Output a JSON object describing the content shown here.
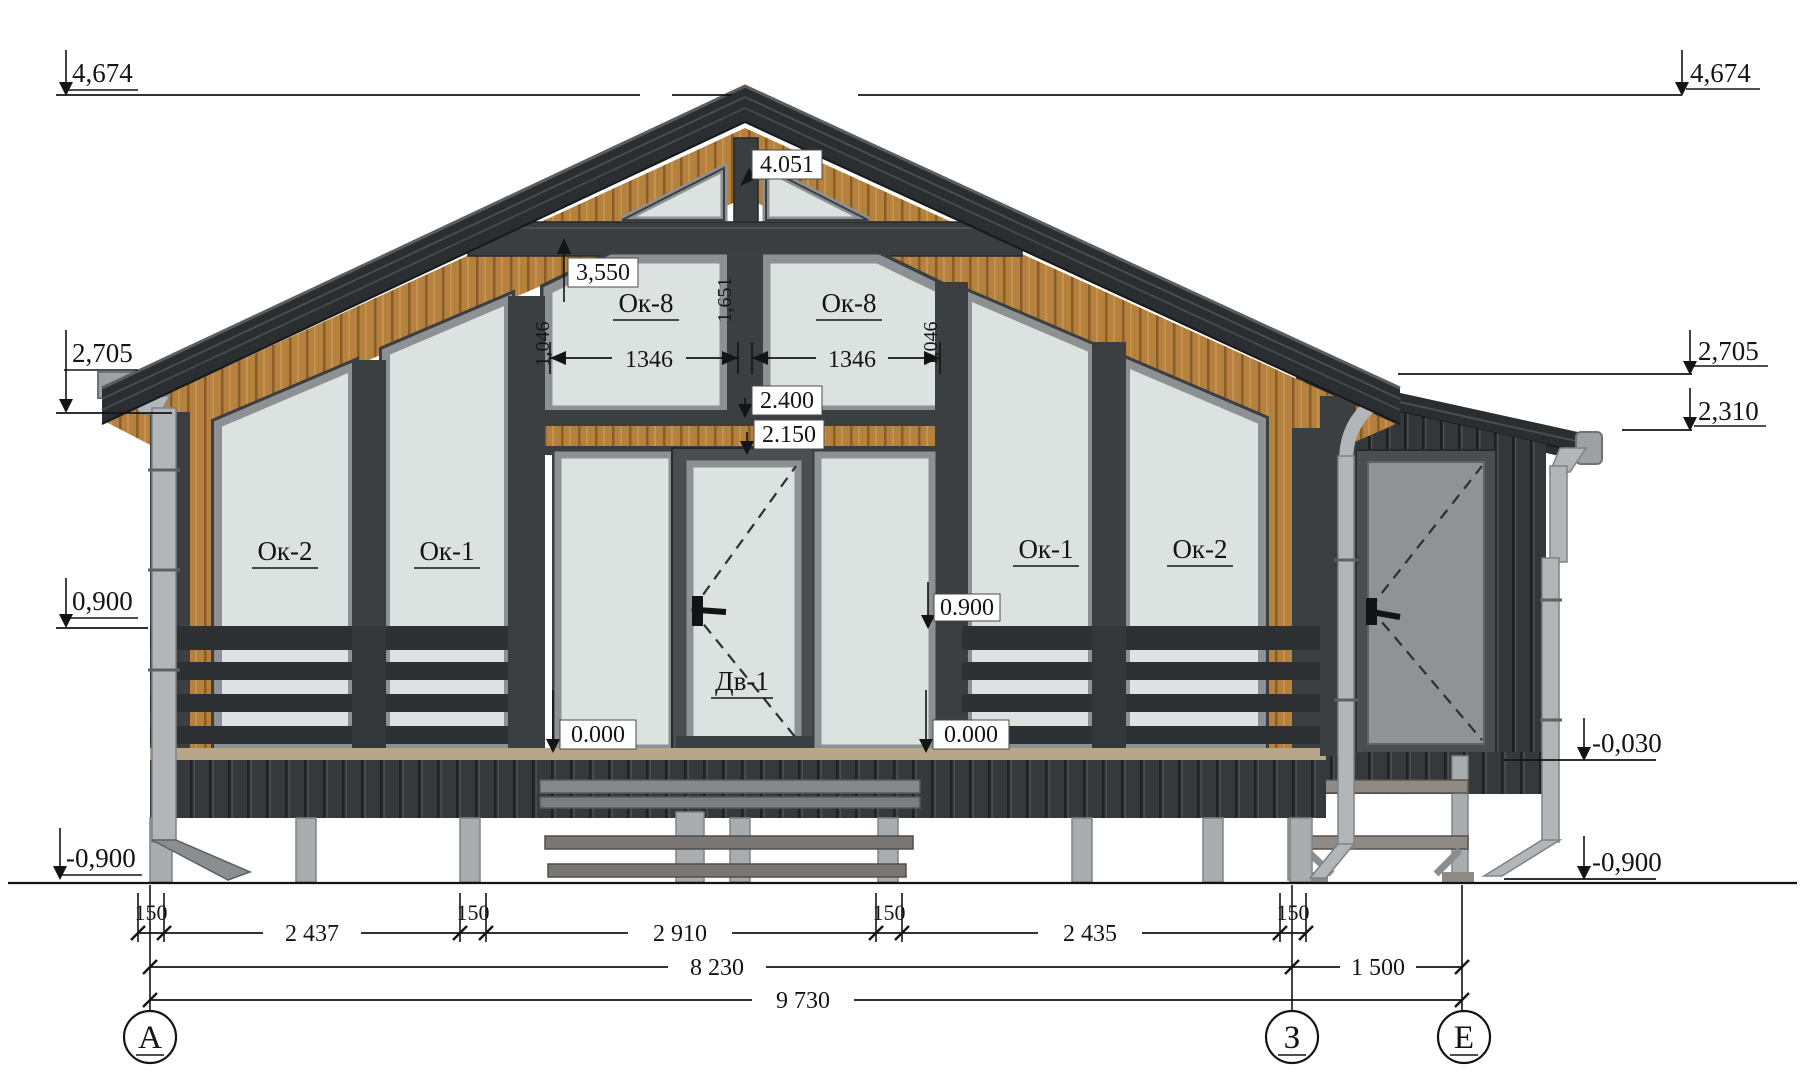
{
  "drawing": {
    "type": "architectural-elevation",
    "levels_left": {
      "l0": "4,674",
      "l1": "2,705",
      "l2": "0,900",
      "l3": "-0,900"
    },
    "levels_right": {
      "r0": "4,674",
      "r1": "2,705",
      "r2": "2,310",
      "r3": "-0,030",
      "r4": "-0,900"
    },
    "marks": {
      "ridge": "4.051",
      "gable": "3,550",
      "lintel": "2.400",
      "door_head": "2.150",
      "floor_left": "0.000",
      "floor_right": "0.000",
      "rail": "0.900"
    },
    "windows": {
      "ok2_left": "Ок-2",
      "ok1_left": "Ок-1",
      "ok8_left": "Ок-8",
      "ok8_right": "Ок-8",
      "ok1_right": "Ок-1",
      "ok2_right": "Ок-2",
      "door": "Дв-1"
    },
    "window_dims": {
      "w_left": "1346",
      "w_right": "1346",
      "h_center": "1,651",
      "h_left": "1,046",
      "h_right": "1,046"
    },
    "dims_row1": [
      "150",
      "2 437",
      "150",
      "2 910",
      "150",
      "2 435",
      "150"
    ],
    "dims_row2": [
      "8 230",
      "1 500"
    ],
    "dims_row3": [
      "9 730"
    ],
    "axes": [
      "А",
      "З",
      "Е"
    ],
    "colors": {
      "roof": "#2b2e31",
      "wood": "#b5813f",
      "glass": "#dce2df",
      "frame_grey": "#8d9193",
      "dark": "#3b3f42",
      "pile": "#a9adaf"
    }
  }
}
